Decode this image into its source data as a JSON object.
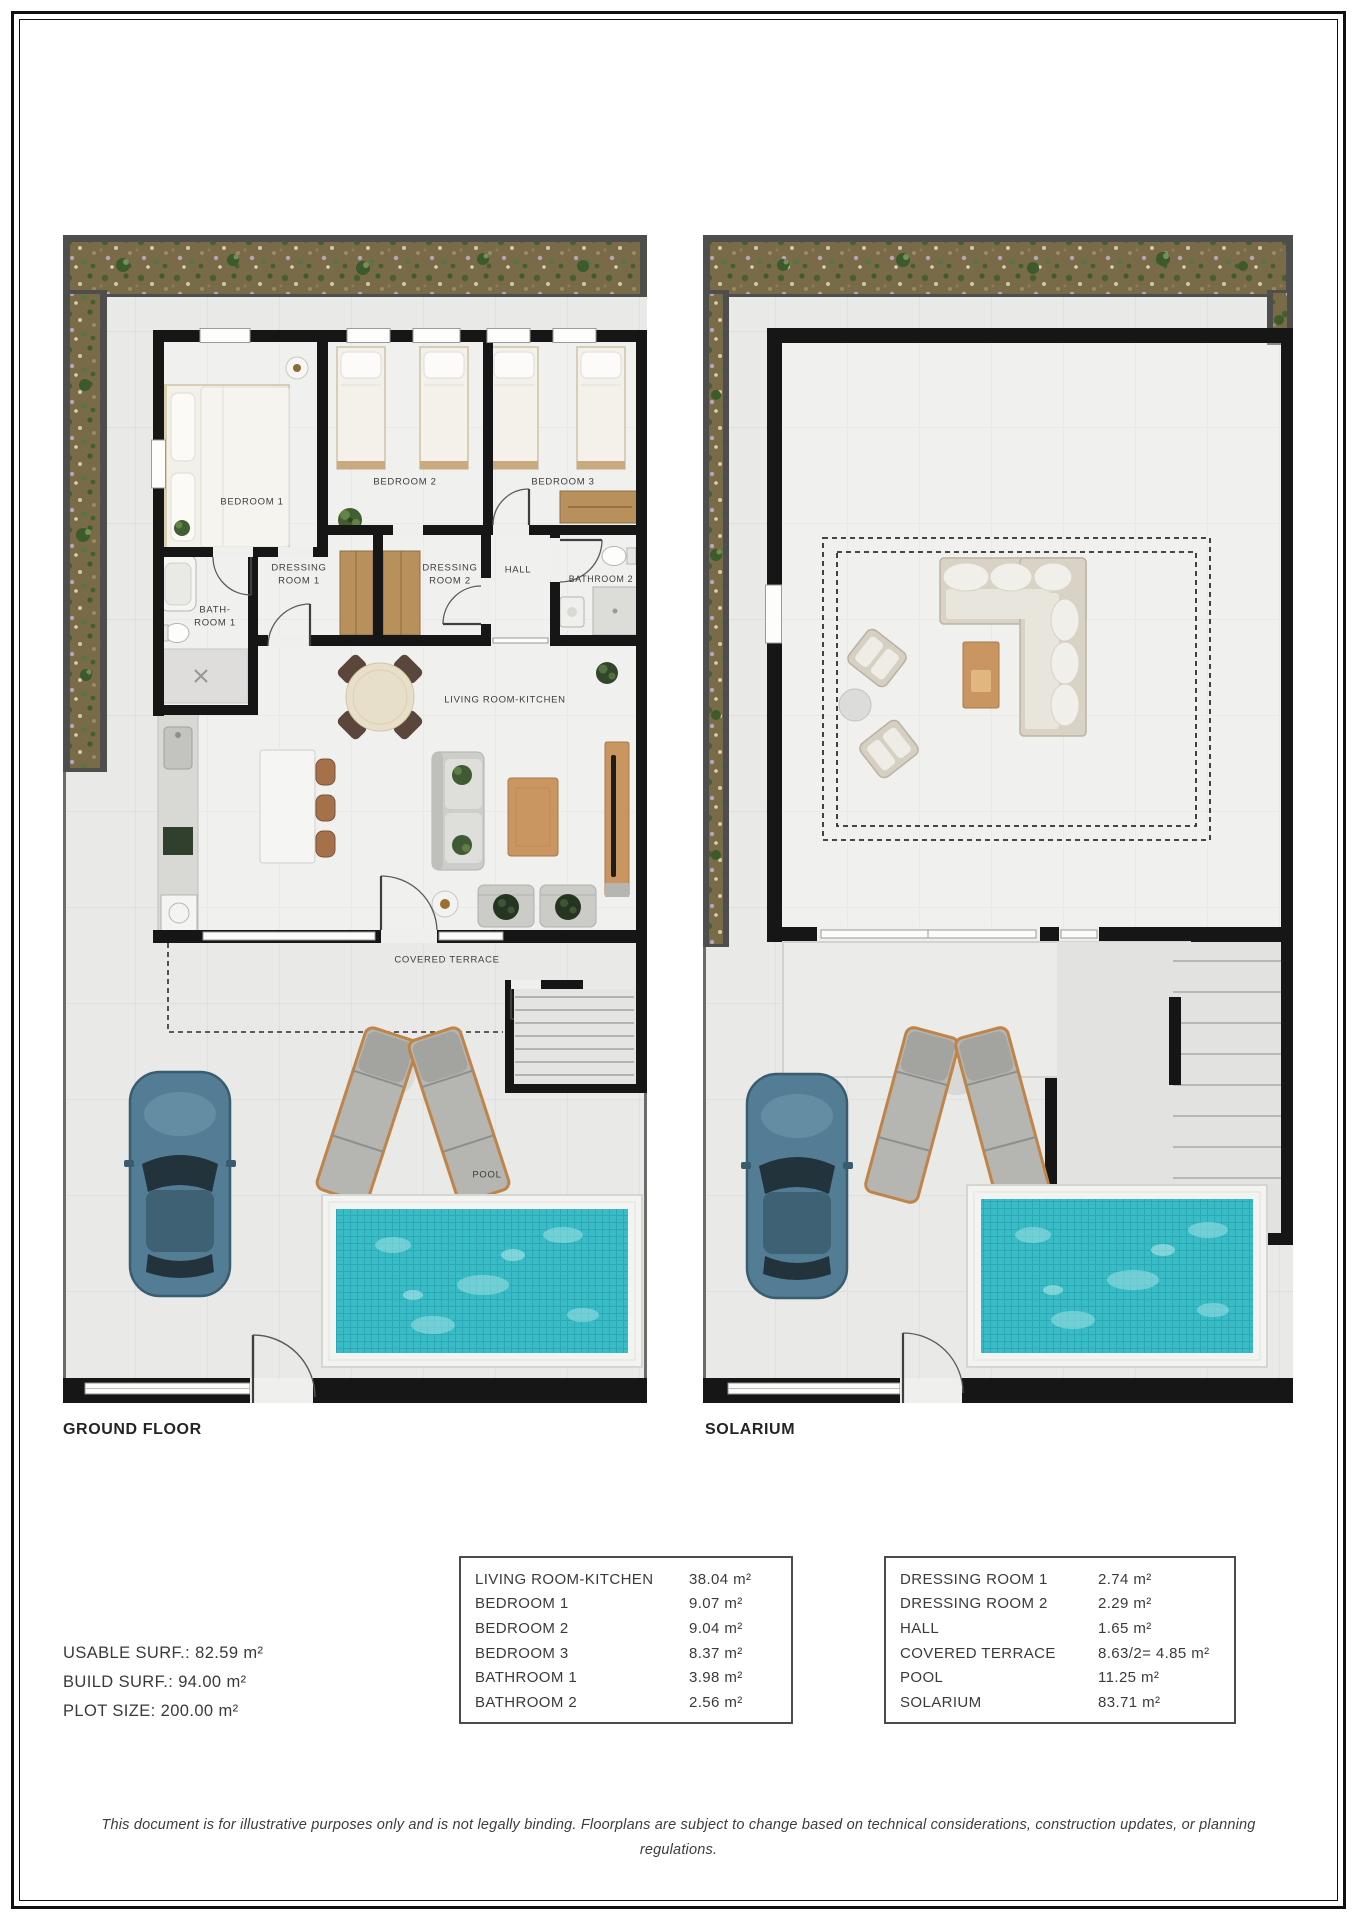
{
  "ground_floor": {
    "title": "GROUND FLOOR",
    "rooms": {
      "bedroom1": "BEDROOM 1",
      "bedroom2": "BEDROOM 2",
      "bedroom3": "BEDROOM 3",
      "dressing1": "DRESSING ROOM 1",
      "dressing2": "DRESSING ROOM 2",
      "hall": "HALL",
      "bath1": "BATH-ROOM 1",
      "bath2": "BATHROOM 2",
      "living": "LIVING ROOM-KITCHEN",
      "terrace": "COVERED TERRACE",
      "pool": "POOL"
    }
  },
  "solarium": {
    "title": "SOLARIUM"
  },
  "stats": {
    "usable": "USABLE SURF.: 82.59 m²",
    "build": "BUILD SURF.: 94.00 m²",
    "plot": "PLOT SIZE: 200.00 m²"
  },
  "area_tables": [
    {
      "name": "interior",
      "rows": [
        {
          "label": "LIVING ROOM-KITCHEN",
          "value": "38.04 m²"
        },
        {
          "label": "BEDROOM 1",
          "value": "9.07 m²"
        },
        {
          "label": "BEDROOM 2",
          "value": "9.04 m²"
        },
        {
          "label": "BEDROOM 3",
          "value": "8.37 m²"
        },
        {
          "label": "BATHROOM 1",
          "value": "3.98 m²"
        },
        {
          "label": "BATHROOM 2",
          "value": "2.56 m²"
        }
      ]
    },
    {
      "name": "exterior",
      "rows": [
        {
          "label": "DRESSING ROOM 1",
          "value": "2.74 m²"
        },
        {
          "label": "DRESSING ROOM 2",
          "value": "2.29 m²"
        },
        {
          "label": "HALL",
          "value": "1.65 m²"
        },
        {
          "label": "COVERED TERRACE",
          "value": "8.63/2= 4.85 m²"
        },
        {
          "label": "POOL",
          "value": "11.25 m²"
        },
        {
          "label": "SOLARIUM",
          "value": "83.71 m²"
        }
      ]
    }
  ],
  "disclaimer": "This document is for illustrative purposes only and is not legally binding. Floorplans are subject to change based on technical considerations, construction updates, or planning regulations.",
  "colors": {
    "wall": "#161616",
    "pool_water": "#3abcc6",
    "garden": "#796a48",
    "wood": "#b8905c",
    "tile": "#e9e9e7"
  }
}
